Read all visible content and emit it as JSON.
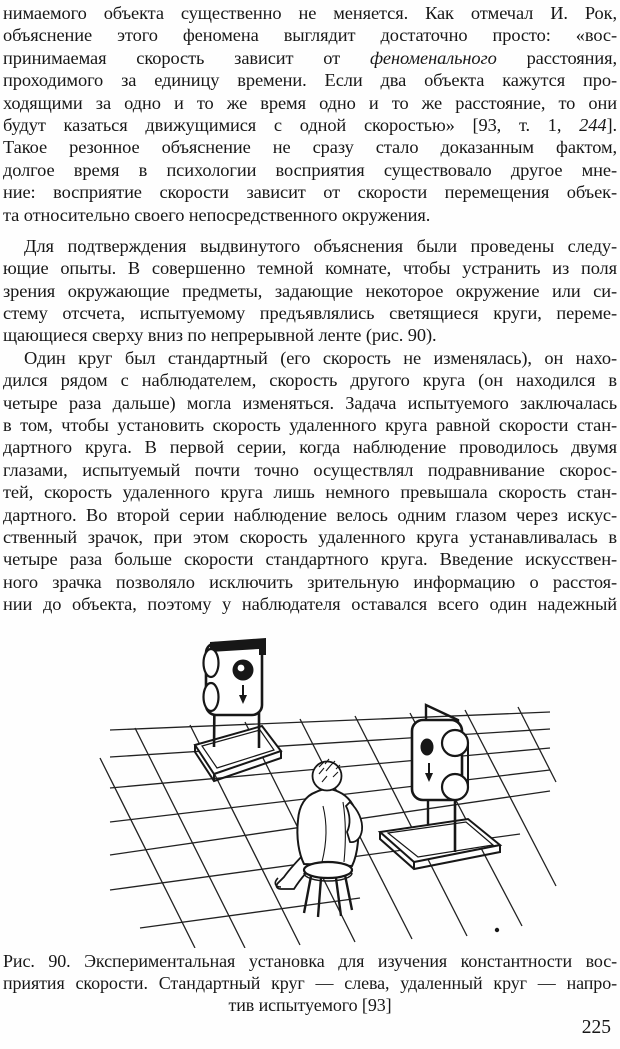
{
  "page": {
    "number": "225",
    "ink_color": "#171717",
    "paper_color": "#fefefe"
  },
  "body": {
    "paragraphs": [
      {
        "gap": 0,
        "lines": [
          {
            "ind": 0,
            "end": 0,
            "segs": [
              {
                "t": "нимаемого объекта существенно не меняется. Как отмечал И. Рок,"
              }
            ]
          },
          {
            "ind": 0,
            "end": 0,
            "segs": [
              {
                "t": "объяснение этого феномена выглядит достаточно просто: «вос-"
              }
            ]
          },
          {
            "ind": 0,
            "end": 0,
            "segs": [
              {
                "t": "принимаемая скорость зависит от "
              },
              {
                "t": "феноменального",
                "i": 1
              },
              {
                "t": " расстояния,"
              }
            ]
          },
          {
            "ind": 0,
            "end": 0,
            "segs": [
              {
                "t": "проходимого за единицу времени. Если два объекта кажутся про-"
              }
            ]
          },
          {
            "ind": 0,
            "end": 0,
            "segs": [
              {
                "t": "ходящими за одно и то же время одно и то же расстояние, то они"
              }
            ]
          },
          {
            "ind": 0,
            "end": 0,
            "segs": [
              {
                "t": "будут казаться движущимися с одной скоростью» [93, т. 1, "
              },
              {
                "t": "244",
                "i": 1
              },
              {
                "t": "]."
              }
            ]
          },
          {
            "ind": 0,
            "end": 0,
            "segs": [
              {
                "t": "Такое резонное объяснение не сразу стало доказанным фактом,"
              }
            ]
          },
          {
            "ind": 0,
            "end": 0,
            "segs": [
              {
                "t": "долгое время в психологии восприятия существовало другое мне-"
              }
            ]
          },
          {
            "ind": 0,
            "end": 0,
            "segs": [
              {
                "t": "ние: восприятие скорости зависит от скорости перемещения объек-"
              }
            ]
          },
          {
            "ind": 0,
            "end": 1,
            "segs": [
              {
                "t": "та относительно своего непосредственного окружения."
              }
            ]
          }
        ]
      },
      {
        "gap": 1,
        "lines": [
          {
            "ind": 1,
            "end": 0,
            "segs": [
              {
                "t": "Для подтверждения выдвинутого объяснения были проведены следу-"
              }
            ]
          },
          {
            "ind": 0,
            "end": 0,
            "segs": [
              {
                "t": "ющие опыты. В совершенно темной комнате, чтобы устранить из поля"
              }
            ]
          },
          {
            "ind": 0,
            "end": 0,
            "segs": [
              {
                "t": "зрения окружающие предметы, задающие некоторое окружение или си-"
              }
            ]
          },
          {
            "ind": 0,
            "end": 0,
            "segs": [
              {
                "t": "стему отсчета, испытуемому предъявлялись светящиеся круги, переме-"
              }
            ]
          },
          {
            "ind": 0,
            "end": 1,
            "segs": [
              {
                "t": "щающиеся сверху вниз по непрерывной ленте (рис. 90)."
              }
            ]
          }
        ]
      },
      {
        "gap": 0,
        "lines": [
          {
            "ind": 1,
            "end": 0,
            "segs": [
              {
                "t": "Один круг был стандартный (его скорость не изменялась), он нахо-"
              }
            ]
          },
          {
            "ind": 0,
            "end": 0,
            "segs": [
              {
                "t": "дился рядом с наблюдателем, скорость другого круга (он находился в"
              }
            ]
          },
          {
            "ind": 0,
            "end": 0,
            "segs": [
              {
                "t": "четыре раза дальше) могла изменяться. Задача испытуемого заключалась"
              }
            ]
          },
          {
            "ind": 0,
            "end": 0,
            "segs": [
              {
                "t": "в том, чтобы установить скорость удаленного круга равной скорости стан-"
              }
            ]
          },
          {
            "ind": 0,
            "end": 0,
            "segs": [
              {
                "t": "дартного круга. В первой серии, когда наблюдение проводилось двумя"
              }
            ]
          },
          {
            "ind": 0,
            "end": 0,
            "segs": [
              {
                "t": "глазами, испытуемый почти точно осуществлял подравнивание скорос-"
              }
            ]
          },
          {
            "ind": 0,
            "end": 0,
            "segs": [
              {
                "t": "тей, скорость удаленного круга лишь немного превышала скорость стан-"
              }
            ]
          },
          {
            "ind": 0,
            "end": 0,
            "segs": [
              {
                "t": "дартного. Во второй серии наблюдение велось одним глазом через искус-"
              }
            ]
          },
          {
            "ind": 0,
            "end": 0,
            "segs": [
              {
                "t": "ственный зрачок, при этом скорость удаленного круга устанавливалась в"
              }
            ]
          },
          {
            "ind": 0,
            "end": 0,
            "segs": [
              {
                "t": "четыре раза больше скорости стандартного круга. Введение искусствен-"
              }
            ]
          },
          {
            "ind": 0,
            "end": 0,
            "segs": [
              {
                "t": "ного зрачка позволяло исключить зрительную информацию о расстоя-"
              }
            ]
          },
          {
            "ind": 0,
            "end": 0,
            "segs": [
              {
                "t": "нии до объекта, поэтому у наблюдателя оставался всего один надежный"
              }
            ]
          }
        ]
      }
    ]
  },
  "figure": {
    "down_arrow_glyph": "↓",
    "caption_lines": [
      {
        "center": 0,
        "text": "Рис. 90. Экспериментальная установка для изучения константности вос-"
      },
      {
        "center": 0,
        "text": "приятия скорости. Стандартный круг — слева, удаленный круг — напро-"
      },
      {
        "center": 1,
        "text": "тив испытуемого [93]"
      }
    ]
  }
}
